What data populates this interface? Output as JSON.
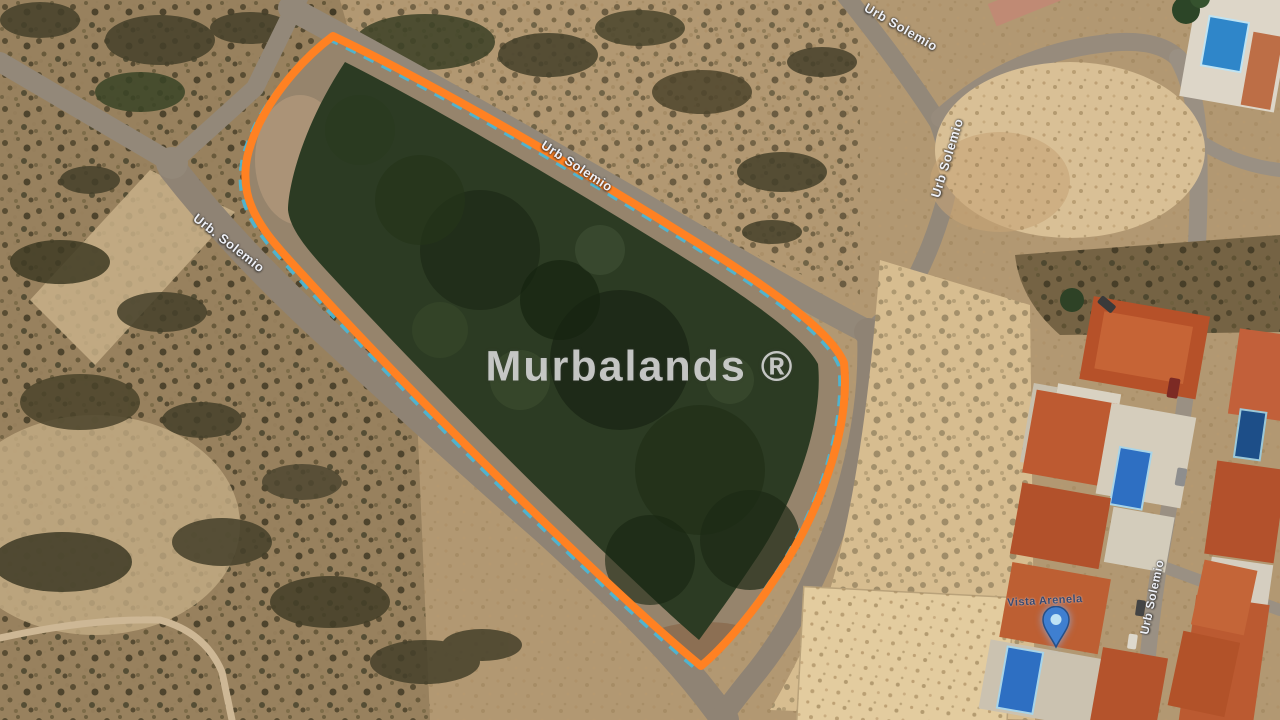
{
  "map": {
    "watermark": "Murbalands ®",
    "street_labels": [
      {
        "text": "Urb. Solemio"
      },
      {
        "text": "Urb Solemio"
      },
      {
        "text": "Urb Solemio"
      },
      {
        "text": "Urb Solemio"
      },
      {
        "text": "Urb Solemio"
      }
    ],
    "place_label": "Vista Arenela",
    "colors": {
      "plot_outline": "#ff8122",
      "cadastral_dashes": "#49b8d8",
      "pin": "#3f7fd0",
      "forest": "#2c3b23",
      "sand": "#d7bd90",
      "road": "#938879",
      "watermark": "#dedede"
    }
  }
}
